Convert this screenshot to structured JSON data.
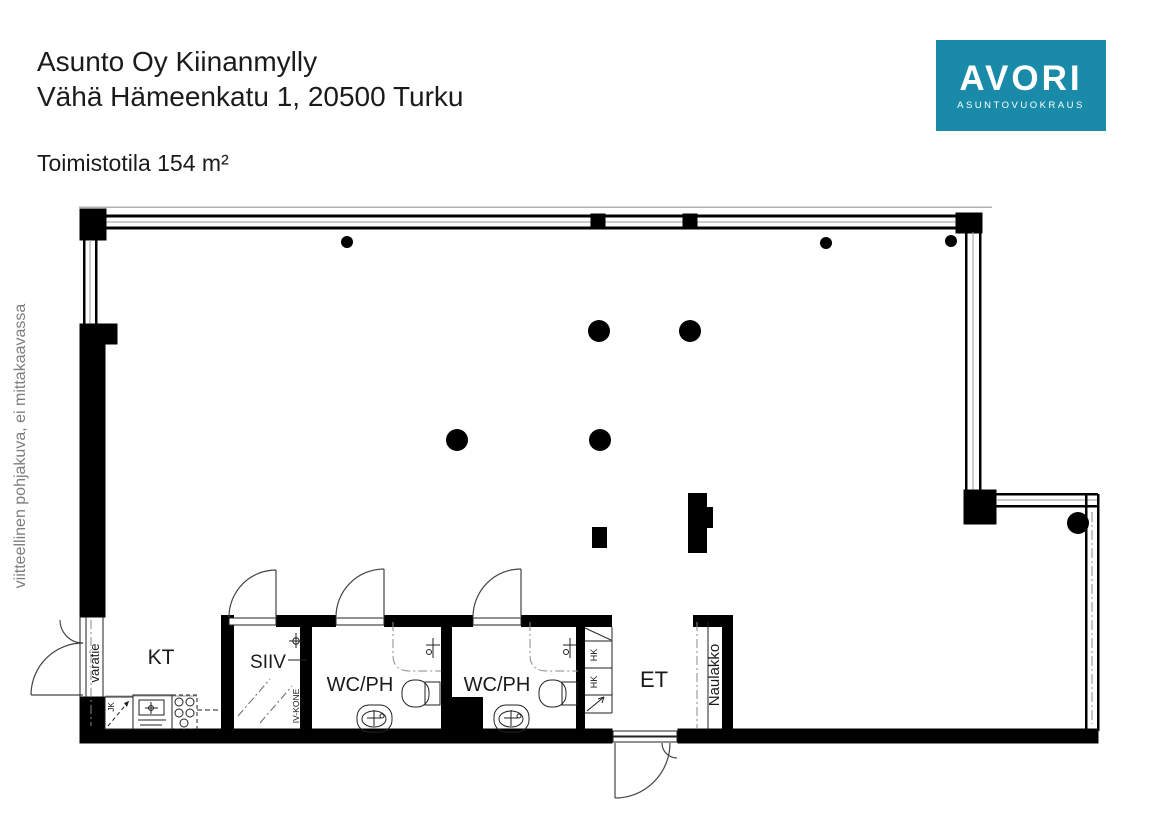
{
  "header": {
    "title": "Asunto Oy Kiinanmylly",
    "address": "Vähä Hämeenkatu 1, 20500 Turku",
    "area_label": "Toimistotila 154 m²"
  },
  "logo": {
    "brand": "AVORI",
    "tagline": "ASUNTOVUOKRAUS",
    "background": "#1a8aa9",
    "text_color": "#ffffff"
  },
  "side_note": "viitteellinen pohjakuva, ei mittakaavassa",
  "plan": {
    "labels": {
      "kt": "KT",
      "siiv": "SIIV",
      "wc_left": "WC/PH",
      "wc_right": "WC/PH",
      "et": "ET",
      "naulakko": "Naulakko",
      "varatie": "varatie",
      "iv_kone": "IV-KONE",
      "jk": "JK",
      "hk_upper": "HK",
      "hk_lower": "HK"
    },
    "colors": {
      "wall": "#000000",
      "line": "#1a1a1a",
      "muted": "#8a8a8a"
    }
  }
}
